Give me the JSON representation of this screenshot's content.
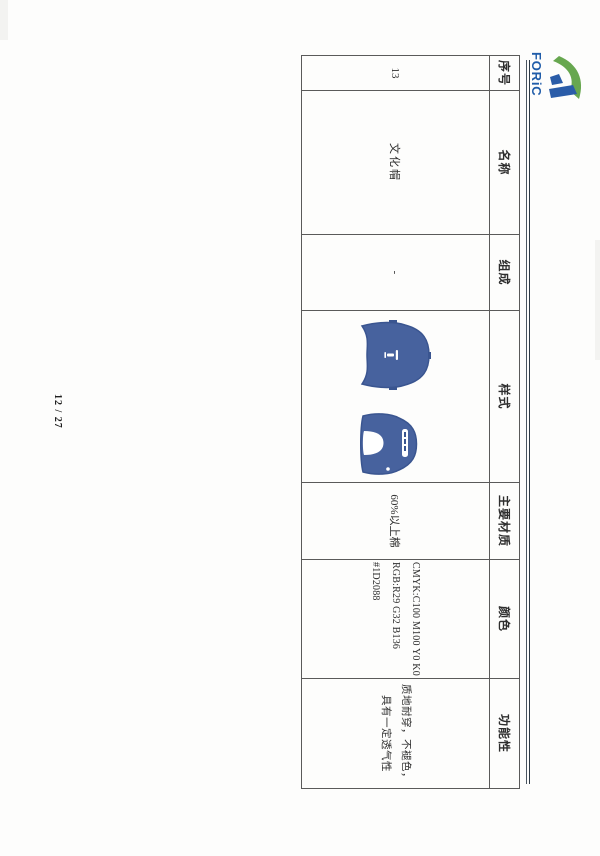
{
  "letterhead": {
    "brand": "FORiC"
  },
  "page": {
    "number": "12 / 27"
  },
  "colors": {
    "brand_blue": "#1f5ca9",
    "logo_green": "#67a74f",
    "logo_blue": "#2a5ca8",
    "cap_blue": "#47629e",
    "cap_blue_dark": "#3a5590",
    "spec_hex": "#1D2088"
  },
  "table": {
    "headers": [
      "序号",
      "名称",
      "组成",
      "样式",
      "主要材质",
      "颜色",
      "功能性"
    ],
    "row": {
      "serial": "13",
      "name": "文化帽",
      "composition": "-",
      "material": "60%以上棉",
      "color_lines": [
        "CMYK:C100 M100 Y0 K0",
        "RGB:R29 G32 B136",
        "#1D2088"
      ],
      "function_lines": [
        "质地耐穿，不褪色，",
        "具有一定透气性"
      ]
    }
  }
}
